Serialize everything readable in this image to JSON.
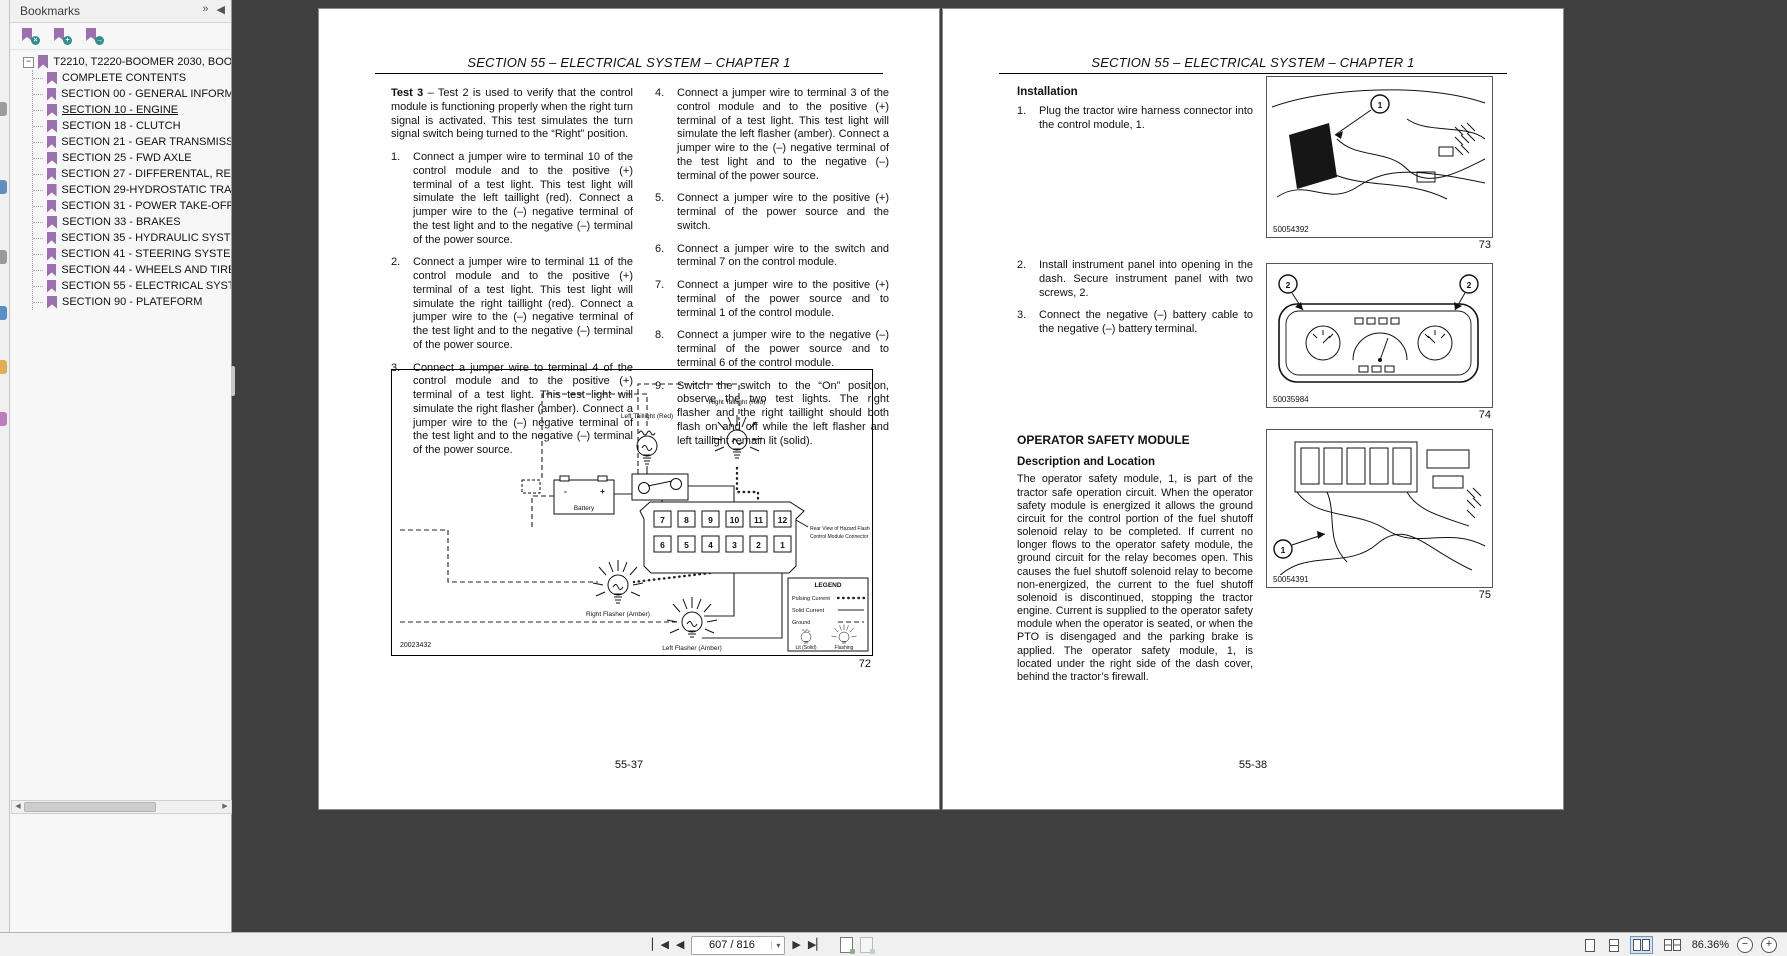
{
  "colors": {
    "canvas_bg": "#3f3f3f",
    "panel_bg": "#f7f7f7",
    "bookmark_purple": "#9c6fae",
    "badge_teal": "#2f8e8e",
    "page_bg": "#ffffff",
    "toolbar_bg": "#f0f0f0"
  },
  "left_strip": {
    "icons": [
      {
        "name": "side-panel-icon-1",
        "color": "#8d8d8d"
      },
      {
        "name": "side-panel-icon-2",
        "color": "#4a7dbb"
      },
      {
        "name": "side-panel-icon-3",
        "color": "#8a8a8a"
      },
      {
        "name": "side-panel-icon-4",
        "color": "#3f7fbf"
      },
      {
        "name": "side-panel-icon-5",
        "color": "#e0a13c"
      },
      {
        "name": "side-panel-icon-6",
        "color": "#b06ab0"
      }
    ]
  },
  "bookmarks_panel": {
    "title": "Bookmarks",
    "header_icons": {
      "expand": "»",
      "collapse": "◀"
    },
    "toolbar": {
      "delete_glyph": "×",
      "add_glyph": "+",
      "goto_glyph": "→"
    },
    "root": {
      "expander": "−",
      "label": "T2210, T2220-BOOMER 2030, BOOM"
    },
    "items": [
      {
        "label": "COMPLETE CONTENTS"
      },
      {
        "label": "SECTION 00 - GENERAL INFORMAT"
      },
      {
        "label": "SECTION 10 - ENGINE",
        "active": true
      },
      {
        "label": "SECTION 18 - CLUTCH"
      },
      {
        "label": "SECTION 21 - GEAR TRANSMISSIO"
      },
      {
        "label": "SECTION 25 - FWD AXLE"
      },
      {
        "label": "SECTION 27 - DIFFERENTAL, REAR"
      },
      {
        "label": "SECTION 29-HYDROSTATIC TRAN"
      },
      {
        "label": "SECTION 31 - POWER TAKE-OFF S"
      },
      {
        "label": "SECTION 33 - BRAKES"
      },
      {
        "label": "SECTION 35 - HYDRAULIC SYSTEM"
      },
      {
        "label": "SECTION 41 - STEERING SYSTEMS"
      },
      {
        "label": "SECTION 44 - WHEELS AND TIRES"
      },
      {
        "label": "SECTION 55 - ELECTRICAL SYSTE"
      },
      {
        "label": "SECTION 90 - PLATEFORM"
      }
    ],
    "scrollbar": {
      "left_arrow": "◀",
      "right_arrow": "▶"
    }
  },
  "doc": {
    "header": "SECTION 55 – ELECTRICAL SYSTEM – CHAPTER 1",
    "left_page": {
      "intro_bold": "Test 3",
      "intro_rest": " – Test 2 is used to verify that the control module is functioning properly when the right turn signal is activated. This test simulates the turn signal switch being turned to the “Right” position.",
      "col1_items": [
        {
          "num": "1.",
          "text": "Connect a jumper wire to terminal 10 of the control module and to the positive (+) terminal of a test light. This test light will simulate the left taillight (red). Connect a jumper wire to the (–) negative terminal of the test light and to the negative (–) terminal of the power source."
        },
        {
          "num": "2.",
          "text": "Connect a jumper wire to terminal 11 of the control module and to the positive (+) terminal of a test light. This test light will simulate the right taillight (red). Connect a jumper wire to the (–) negative terminal of the test light and to the negative (–) terminal of the power source."
        },
        {
          "num": "3.",
          "text": "Connect a jumper wire to terminal 4 of the control module and to the positive (+) terminal of a test light. This test light will simulate the right flasher (amber). Connect a jumper wire to the (–) negative terminal of the test light and to the negative (–) terminal of the power source."
        }
      ],
      "col2_items": [
        {
          "num": "4.",
          "text": "Connect a jumper wire to terminal 3 of the control module and to the positive (+) terminal of a test light. This test light will simulate the left flasher (amber). Connect a jumper wire to the (–) negative terminal of the test light and to the negative (–) terminal of the power source."
        },
        {
          "num": "5.",
          "text": "Connect a jumper wire to the positive (+) terminal of the power source and the switch."
        },
        {
          "num": "6.",
          "text": "Connect a jumper wire to the switch and terminal 7 on the control module."
        },
        {
          "num": "7.",
          "text": "Connect a jumper wire to the positive (+) terminal of the power source and to terminal 1 of the control module."
        },
        {
          "num": "8.",
          "text": "Connect a jumper wire to the negative (–) terminal of the power source and to terminal 6 of the control module."
        },
        {
          "num": "9.",
          "text": "Switch the switch to the “On” position, observe the two test lights. The right flasher and the right taillight should both flash on and off while the left flasher and left taillight remain lit (solid)."
        }
      ],
      "figure": {
        "labels": {
          "left_taillight": "Left Taillight (Red)",
          "right_taillight": "Right Taillight (Red)",
          "battery": "Battery",
          "battery_minus": "-",
          "battery_plus": "+",
          "switch": "Switch",
          "connector_caption1": "Rear View of Hazard Flasher",
          "connector_caption2": "Control Module Connector",
          "right_flasher": "Right Flasher (Amber)",
          "left_flasher": "Left Flasher (Amber)"
        },
        "pins_top": [
          "7",
          "8",
          "9",
          "10",
          "11",
          "12"
        ],
        "pins_bottom": [
          "6",
          "5",
          "4",
          "3",
          "2",
          "1"
        ],
        "legend": {
          "title": "LEGEND",
          "pulsing": "Pulsing Current",
          "solid": "Solid Current",
          "ground": "Ground",
          "lit": "Lit (Solid)",
          "flashing": "Flashing"
        },
        "part_number": "20023432",
        "figure_number": "72"
      },
      "page_number": "55-37"
    },
    "right_page": {
      "installation_heading": "Installation",
      "step1": {
        "num": "1.",
        "text": "Plug the tractor wire harness connector into the control module, 1."
      },
      "step2": {
        "num": "2.",
        "text": "Install instrument panel into opening in the dash. Secure instrument panel with two screws, 2."
      },
      "step3": {
        "num": "3.",
        "text": "Connect the negative (–) battery cable to the negative (–) battery terminal."
      },
      "fig73": {
        "code": "50054392",
        "number": "73",
        "callout": "1"
      },
      "fig74": {
        "code": "50035984",
        "number": "74",
        "callout_left": "2",
        "callout_right": "2"
      },
      "fig75": {
        "code": "50054391",
        "number": "75",
        "callout": "1"
      },
      "osm_heading": "OPERATOR SAFETY MODULE",
      "osm_subheading": "Description and Location",
      "osm_body": "The operator safety module, 1, is part of the tractor safe operation circuit. When the operator safety module is energized it allows the ground circuit for the control portion of the fuel shutoff solenoid relay to be completed. If current no longer flows to the operator safety module, the ground circuit for the relay becomes open. This causes the fuel shutoff solenoid relay to become non-energized, the current to the fuel shutoff solenoid is discontinued, stopping the tractor engine. Current is supplied to the operator safety module when the operator is seated, or when the PTO is disengaged and the parking brake is applied. The operator safety module, 1, is located under the right side of the dash cover, behind the tractor’s firewall.",
      "page_number": "55-38"
    }
  },
  "toolbar": {
    "first_page": "▏◀",
    "prev_page": "◀",
    "page_field": "607 / 816",
    "dropdown_caret": "▾",
    "next_page": "▶",
    "last_page": "▶▏",
    "zoom_level": "86.36%",
    "zoom_out": "−",
    "zoom_in": "+"
  }
}
